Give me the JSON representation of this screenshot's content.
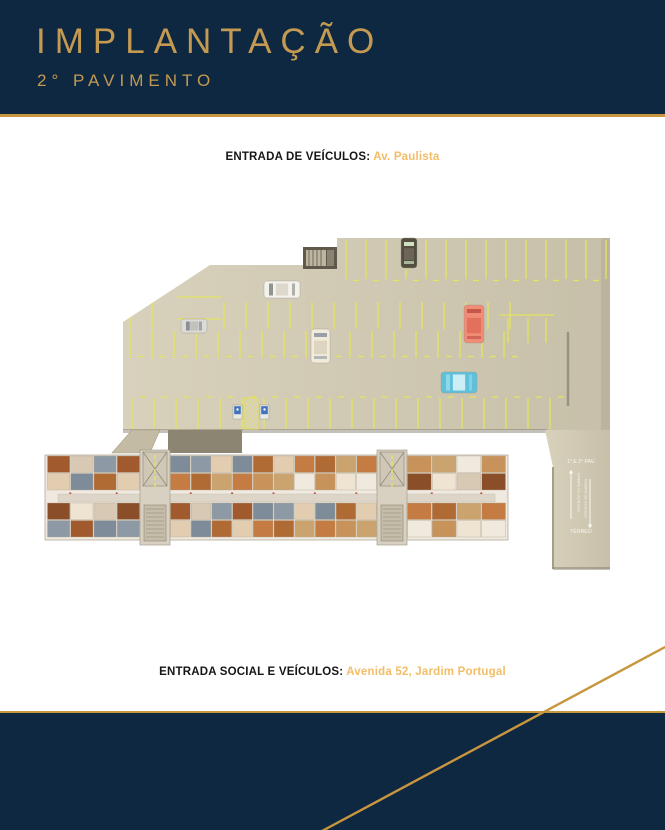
{
  "header": {
    "title": "IMPLANTAÇÃO",
    "subtitle": "2° PAVIMENTO"
  },
  "entrances": {
    "vehicles_label": "ENTRADA DE VEÍCULOS:",
    "vehicles_value": "Av. Paulista",
    "social_label": "ENTRADA SOCIAL E VEÍCULOS:",
    "social_value": "Avenida 52, Jardim Portugal"
  },
  "plan": {
    "ramp": {
      "top_label": "1° E 2° PAV.",
      "bottom_label": "TÉRREO",
      "ramp_text_up": "RAMPA DE ACESSO",
      "ramp_text_down": "RAMPA DE ACESSO"
    },
    "icons": {
      "accessible_sign": "wheelchair-sign",
      "ramp_up": "arrow-up",
      "ramp_down": "arrow-down"
    },
    "cars": [
      {
        "name": "white-sedan-car",
        "x": 264,
        "y": 281,
        "w": 36,
        "h": 17,
        "orient": "h",
        "body": "#f4f2ec",
        "roof": "#dcd8cb",
        "glass": "#8f958f"
      },
      {
        "name": "silver-hatch-car",
        "x": 181,
        "y": 319,
        "w": 26,
        "h": 14,
        "orient": "h",
        "body": "#dbdbd7",
        "roof": "#c1c1bd",
        "glass": "#8a8f93"
      },
      {
        "name": "cream-car",
        "x": 311,
        "y": 329,
        "w": 19,
        "h": 34,
        "orient": "v",
        "body": "#f1ebdb",
        "roof": "#ded5c1",
        "glass": "#9aa0a8"
      },
      {
        "name": "dark-van-car",
        "x": 401,
        "y": 238,
        "w": 16,
        "h": 30,
        "orient": "v",
        "body": "#524d3e",
        "roof": "#6b6657",
        "glass": "#cfe0c0"
      },
      {
        "name": "salmon-car",
        "x": 464,
        "y": 305,
        "w": 20,
        "h": 38,
        "orient": "v",
        "body": "#f08b76",
        "roof": "#e2705c",
        "glass": "#c2574a"
      },
      {
        "name": "blue-car",
        "x": 441,
        "y": 372,
        "w": 36,
        "h": 21,
        "orient": "h",
        "body": "#5fc0da",
        "roof": "#cdeef6",
        "glass": "#8ed8ea"
      }
    ]
  },
  "colors": {
    "navy": "#0d2840",
    "gold": "#c8963f",
    "title_gold": "#c49a52",
    "highlight_gold": "#f2bd66",
    "garage_light": "#d8d1bc",
    "garage_dark": "#c7c0a9",
    "parking_line": "#e4e45e",
    "shadow": "#7c7666",
    "sign_blue": "#4272bc",
    "building_base": "#efe9df",
    "corridor": "#ddd6c8",
    "core": "#d8d1c2",
    "wall": "#a89f8e",
    "door_red": "#c0392b",
    "ramp_text": "#f8f6f0",
    "apartment_palette": [
      "#a05a2e",
      "#c47c42",
      "#8a4f28",
      "#e3cdb0",
      "#f0e9dd",
      "#8d99a4",
      "#caa36e",
      "#d8c9b4",
      "#b06a34",
      "#efe3d2",
      "#7e8b98",
      "#c8935a"
    ]
  }
}
